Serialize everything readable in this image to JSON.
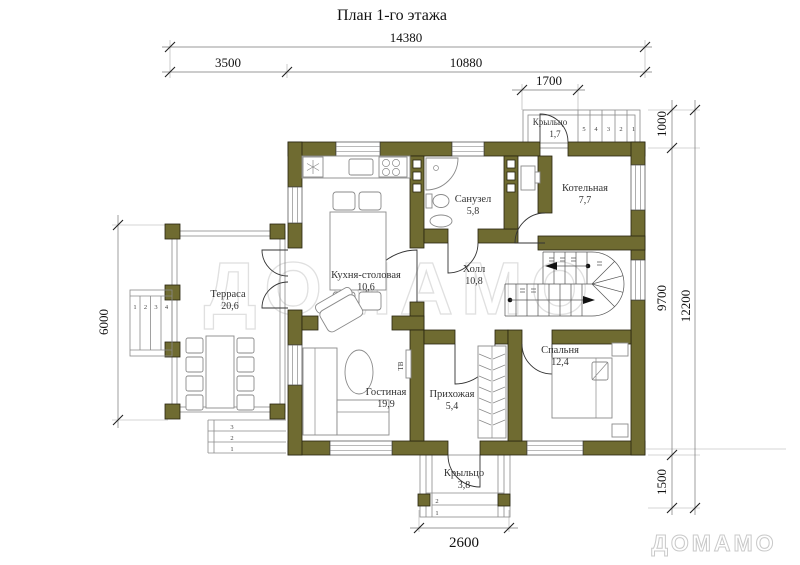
{
  "title": "План 1-го этажа",
  "watermark": {
    "center": "ДОМАМО",
    "corner": "ДОМАМО"
  },
  "colors": {
    "wall": "#6f6b31",
    "watermark": "#e0e0e0"
  },
  "dimensions": {
    "top_total": "14380",
    "top_left": "3500",
    "top_right": "10880",
    "porch_top_width": "1700",
    "right_porch_depth": "1000",
    "right_house": "9700",
    "right_total": "12200",
    "right_porch_bottom": "1500",
    "left_terrace": "6000",
    "bottom_porch_width": "2600"
  },
  "rooms": {
    "kitchen": {
      "name": "Кухня-столовая",
      "area": "10,6"
    },
    "bathroom": {
      "name": "Санузел",
      "area": "5,8"
    },
    "boiler": {
      "name": "Котельная",
      "area": "7,7"
    },
    "hall": {
      "name": "Холл",
      "area": "10,8"
    },
    "terrace": {
      "name": "Терраса",
      "area": "20,6",
      "side_steps": [
        "1",
        "2",
        "3",
        "4"
      ],
      "bottom_steps": [
        "3",
        "2",
        "1"
      ]
    },
    "living": {
      "name": "Гостиная",
      "area": "19,9",
      "tv": "ТВ"
    },
    "entry": {
      "name": "Прихожая",
      "area": "5,4"
    },
    "bedroom": {
      "name": "Спальня",
      "area": "12,4"
    },
    "porch_top": {
      "name": "Крыльцо",
      "area": "1,7",
      "steps": [
        "5",
        "4",
        "3",
        "2",
        "1"
      ]
    },
    "porch_bottom": {
      "name": "Крыльцо",
      "area": "3,8",
      "steps": [
        "2",
        "1"
      ]
    }
  }
}
